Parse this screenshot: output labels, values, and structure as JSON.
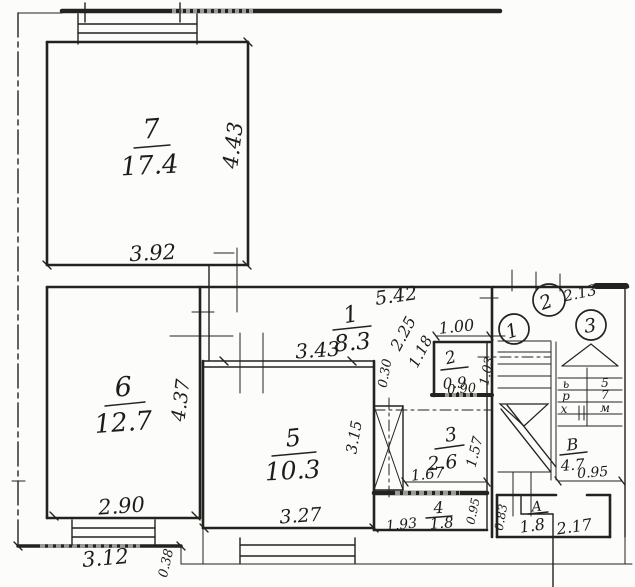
{
  "drawing": {
    "kind": "hand-drawn apartment floor plan sketch",
    "ink_color": "#24221f",
    "paper_color": "#fcfcfa"
  },
  "rooms": {
    "r7": {
      "num": "7",
      "area": "17.4"
    },
    "r6": {
      "num": "6",
      "area": "12.7"
    },
    "r5": {
      "num": "5",
      "area": "10.3"
    },
    "r1": {
      "num": "1",
      "area": "8.3"
    },
    "r2": {
      "num": "2",
      "area": "0.9"
    },
    "r3": {
      "num": "3",
      "area": "2.6"
    },
    "r4": {
      "num": "4",
      "area": "1.8"
    },
    "rV": {
      "num": "В",
      "area": "4.7"
    },
    "rA": {
      "num": "А",
      "area": "1.8"
    }
  },
  "dims": {
    "r7_w": "3.92",
    "r7_h": "4.43",
    "r6_w": "2.90",
    "r6_h": "4.37",
    "r6_w_out": "3.12",
    "r6_wall": "0.38",
    "hall_top": "3.43",
    "r5_w": "3.27",
    "r5_h": "3.15",
    "r1_len": "5.42",
    "r1_diag1": "2.25",
    "r1_diag2": "1.18",
    "r1_wall": "0.30",
    "r2_w_top": "1.00",
    "r2_w_bot": "0.90",
    "r2_h": "1.03",
    "r3_w": "1.67",
    "r3_h": "1.57",
    "r4_w": "1.93",
    "r4_h": "0.95",
    "st_top": "2.13",
    "st_landing": "0.95",
    "corr_w": "2.17",
    "corr_h": "0.83"
  },
  "stairwell": {
    "entry1": "1",
    "entry2": "2",
    "entry3": "3",
    "marks": [
      "ь",
      "5",
      "р",
      "7",
      "х",
      "м"
    ]
  }
}
